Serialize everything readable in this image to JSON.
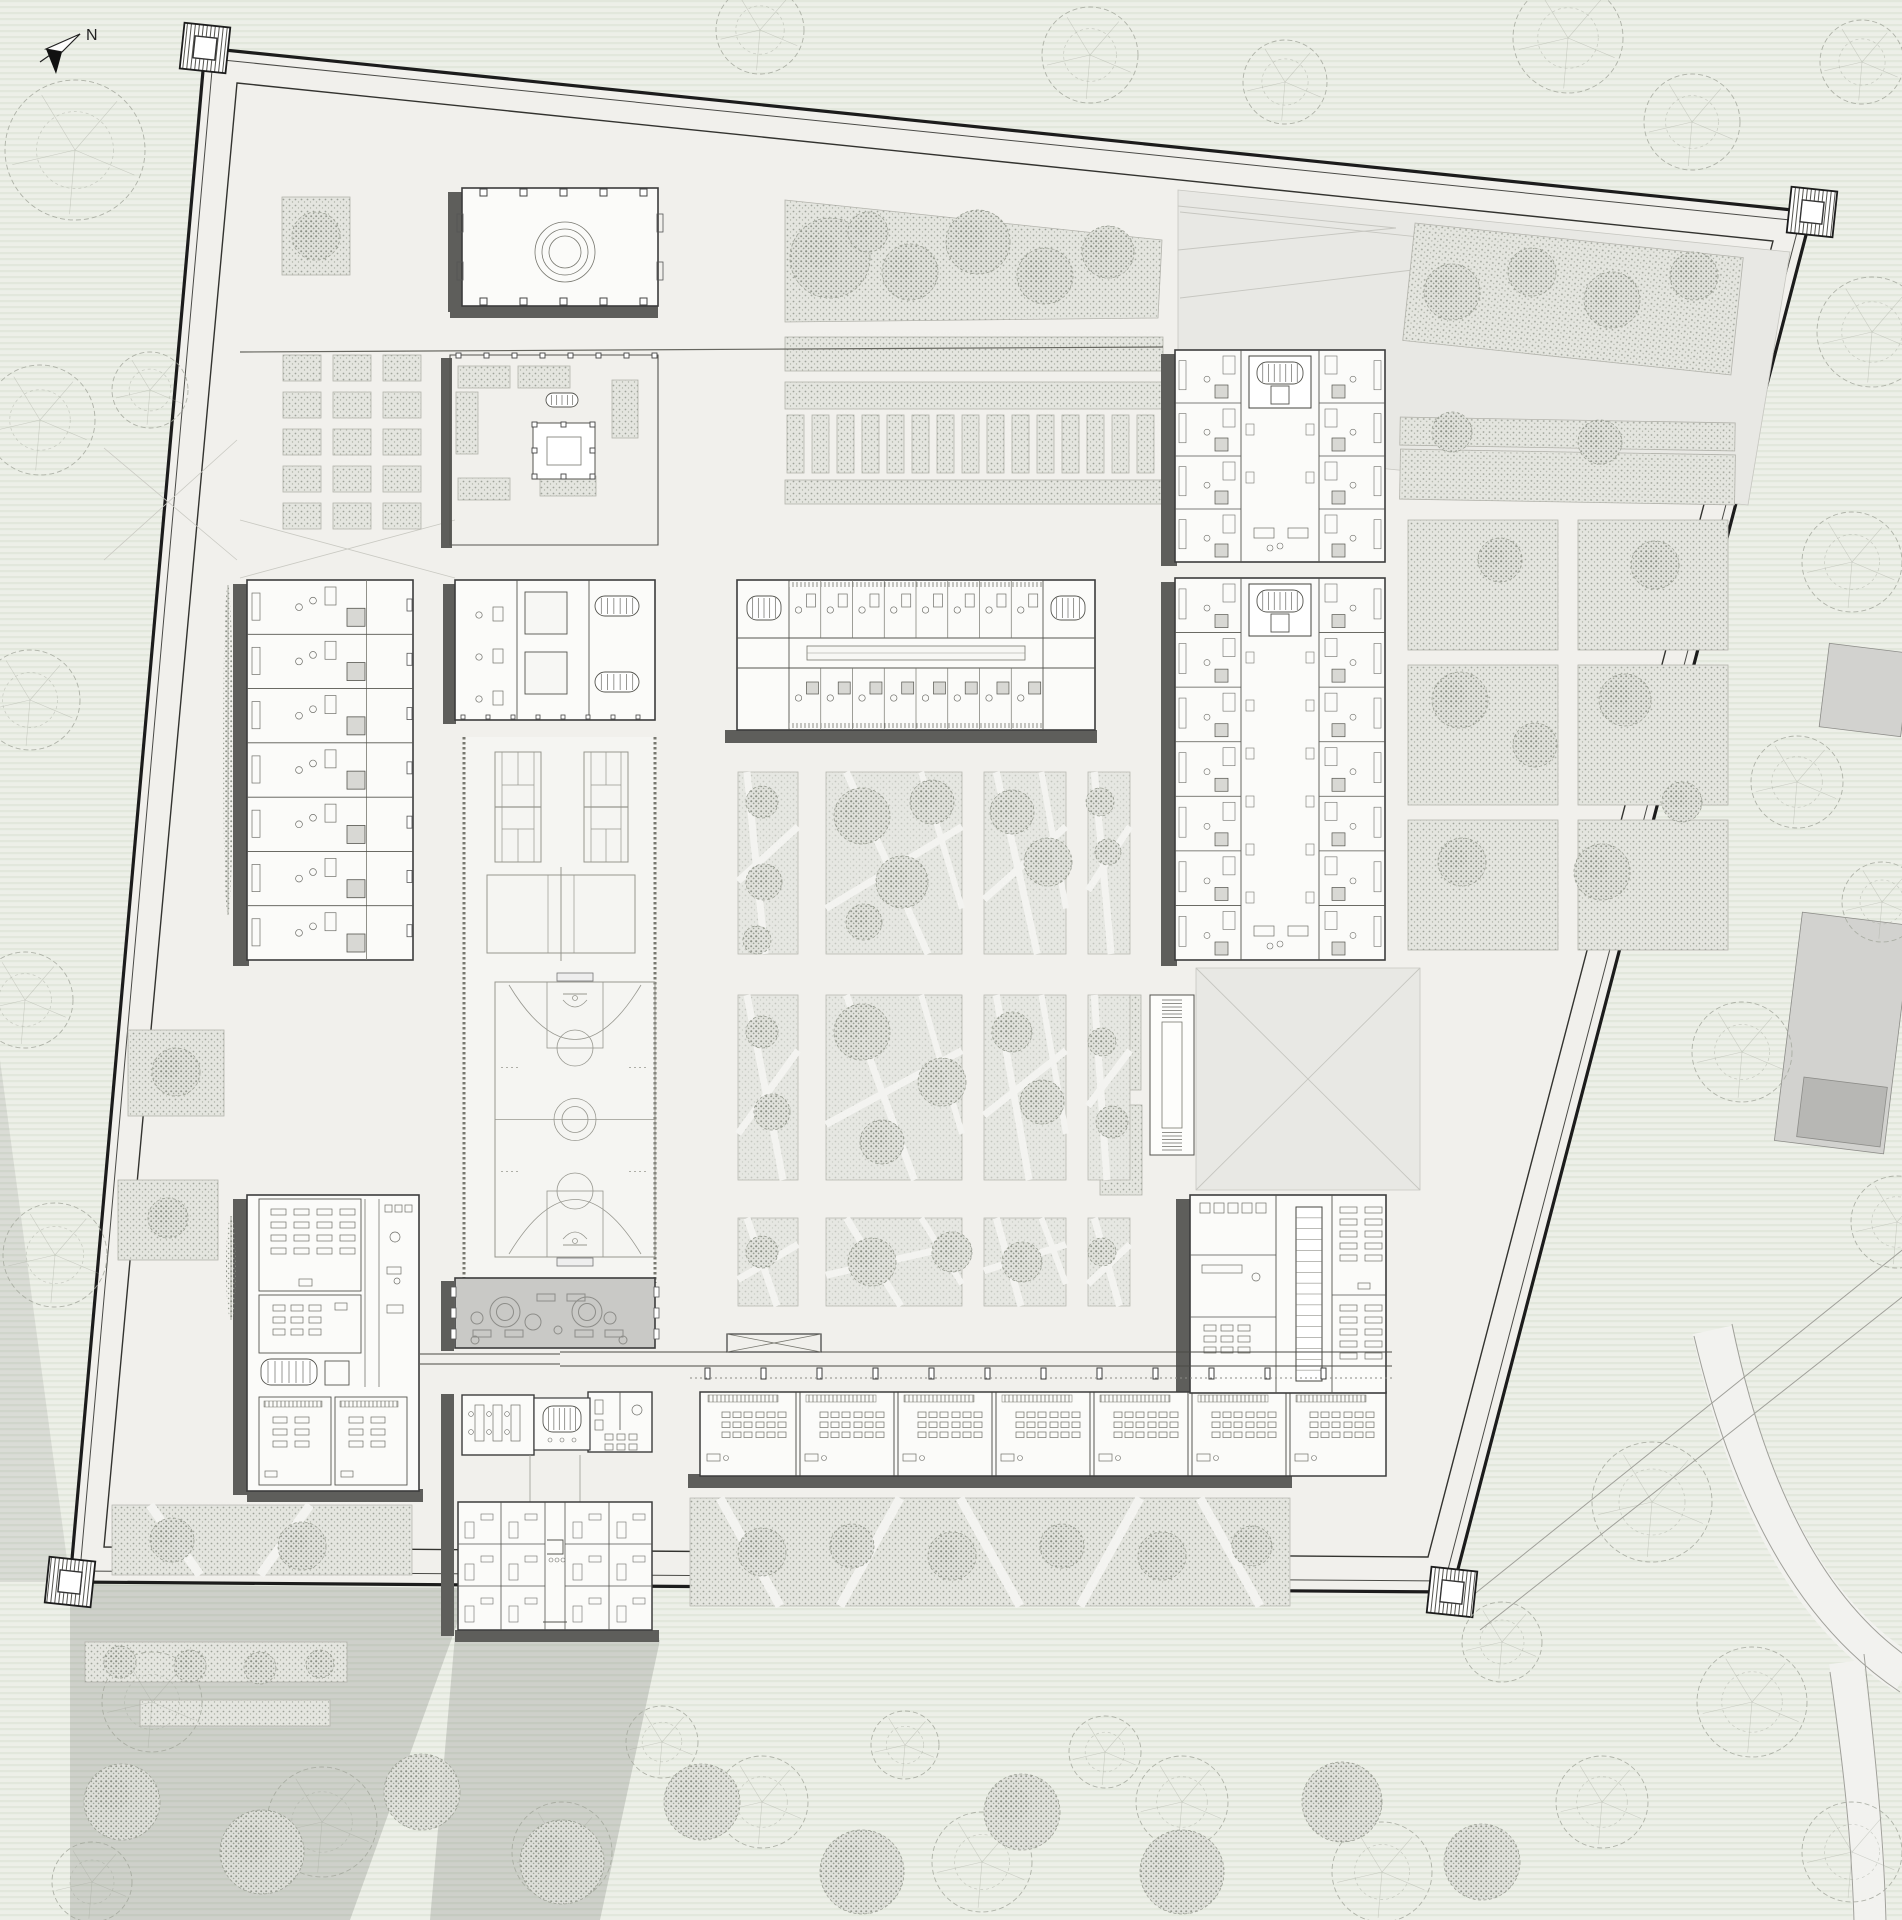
{
  "meta": {
    "title": "walled-campus-site-plan",
    "north_label": "N"
  },
  "canvas": {
    "width": 1902,
    "height": 1920
  },
  "colors": {
    "paper": "#eef0ea",
    "stripe": "#dfe4d8",
    "ground": "#f1f0ec",
    "wall": "#1c1c1c",
    "line": "#3c3c3c",
    "thin": "#8a8a85",
    "shadow": "#5e5e5b",
    "soft_shadow": "rgba(95,100,95,0.22)",
    "stipple_fill": "#e4e5df",
    "stipple_dot": "#a0a49a",
    "tree_line": "#a4a89d",
    "gray_roof": "#c9c9c6",
    "plaza": "#e8e8e4",
    "plaza_line": "#c6c6c0",
    "court_line": "#97978f",
    "court_ground": "#f5f5f2",
    "road_fill": "#f2f2ef",
    "road_line": "#a0a09a",
    "neighbor": "#d2d2cf",
    "neighbor_dark": "#b7b7b4",
    "white": "#fbfbf9"
  },
  "site": {
    "outer": [
      [
        205,
        48
      ],
      [
        1812,
        212
      ],
      [
        1452,
        1592
      ],
      [
        70,
        1582
      ]
    ],
    "inner1": [
      [
        213,
        59
      ],
      [
        1800,
        221
      ],
      [
        1445,
        1581
      ],
      [
        80,
        1571
      ]
    ],
    "inner2": [
      [
        237,
        83
      ],
      [
        1773,
        241
      ],
      [
        1428,
        1557
      ],
      [
        104,
        1547
      ]
    ],
    "towers": [
      [
        205,
        48
      ],
      [
        1812,
        212
      ],
      [
        1452,
        1592
      ],
      [
        70,
        1582
      ]
    ],
    "tower_size": 46,
    "tower_rot": 6
  },
  "shadows": {
    "building": [
      [
        233,
        584,
        16,
        382
      ],
      [
        448,
        192,
        14,
        120
      ],
      [
        450,
        305,
        208,
        13
      ],
      [
        441,
        358,
        11,
        190
      ],
      [
        443,
        584,
        13,
        140
      ],
      [
        725,
        730,
        372,
        13
      ],
      [
        1161,
        354,
        16,
        212
      ],
      [
        1161,
        582,
        16,
        384
      ],
      [
        233,
        1199,
        16,
        296
      ],
      [
        247,
        1489,
        176,
        13
      ],
      [
        441,
        1281,
        13,
        70
      ],
      [
        441,
        1394,
        13,
        242
      ],
      [
        455,
        1630,
        204,
        12
      ],
      [
        1176,
        1199,
        15,
        200
      ],
      [
        688,
        1474,
        604,
        14
      ]
    ],
    "soft": [
      [
        [
          70,
          1584
        ],
        [
          470,
          1588
        ],
        [
          350,
          1920
        ],
        [
          70,
          1920
        ]
      ],
      [
        [
          455,
          1636
        ],
        [
          660,
          1640
        ],
        [
          600,
          1920
        ],
        [
          430,
          1920
        ]
      ],
      [
        [
          0,
          1060
        ],
        [
          70,
          1582
        ],
        [
          0,
          1582
        ]
      ]
    ]
  },
  "plazas": [
    {
      "name": "northeast-plaza",
      "pts": [
        [
          1178,
          190
        ],
        [
          1790,
          252
        ],
        [
          1748,
          505
        ],
        [
          1178,
          448
        ]
      ],
      "lines": [
        [
          1178,
          206,
          1396,
          228
        ],
        [
          1178,
          250,
          1396,
          228
        ],
        [
          1180,
          212,
          1562,
          252
        ],
        [
          1180,
          298,
          1562,
          252
        ]
      ]
    },
    {
      "name": "east-plaza",
      "pts": [
        [
          1196,
          968
        ],
        [
          1420,
          968
        ],
        [
          1420,
          1190
        ],
        [
          1196,
          1190
        ]
      ],
      "lines": [
        [
          1196,
          968,
          1420,
          1190
        ],
        [
          1420,
          968,
          1196,
          1190
        ]
      ]
    }
  ],
  "fold_lines": [
    [
      104,
      448,
      237,
      560
    ],
    [
      237,
      440,
      104,
      560
    ],
    [
      240,
      520,
      455,
      578
    ],
    [
      240,
      578,
      455,
      520
    ]
  ],
  "stipple_polys": [
    [
      [
        785,
        200
      ],
      [
        1162,
        240
      ],
      [
        1158,
        318
      ],
      [
        785,
        322
      ]
    ]
  ],
  "stipple_areas": [
    {
      "x": 282,
      "y": 197,
      "w": 68,
      "h": 78
    },
    {
      "x": 458,
      "y": 366,
      "w": 52,
      "h": 22
    },
    {
      "x": 518,
      "y": 366,
      "w": 52,
      "h": 22
    },
    {
      "x": 612,
      "y": 380,
      "w": 26,
      "h": 58
    },
    {
      "x": 456,
      "y": 392,
      "w": 22,
      "h": 62
    },
    {
      "x": 458,
      "y": 478,
      "w": 52,
      "h": 22
    },
    {
      "x": 540,
      "y": 476,
      "w": 56,
      "h": 20
    },
    {
      "x": 785,
      "y": 337,
      "w": 378,
      "h": 34
    },
    {
      "x": 785,
      "y": 382,
      "w": 378,
      "h": 27
    },
    {
      "x": 785,
      "y": 480,
      "w": 378,
      "h": 24
    },
    {
      "x": 1408,
      "y": 240,
      "w": 330,
      "h": 118,
      "rot": 6
    },
    {
      "x": 1400,
      "y": 420,
      "w": 335,
      "h": 28,
      "rot": 1
    },
    {
      "x": 1400,
      "y": 452,
      "w": 335,
      "h": 50,
      "rot": 1
    },
    {
      "x": 1408,
      "y": 520,
      "w": 150,
      "h": 130
    },
    {
      "x": 1578,
      "y": 520,
      "w": 150,
      "h": 130
    },
    {
      "x": 1408,
      "y": 665,
      "w": 150,
      "h": 140
    },
    {
      "x": 1578,
      "y": 665,
      "w": 150,
      "h": 140
    },
    {
      "x": 1408,
      "y": 820,
      "w": 150,
      "h": 130
    },
    {
      "x": 1578,
      "y": 820,
      "w": 150,
      "h": 130
    },
    {
      "x": 128,
      "y": 1030,
      "w": 96,
      "h": 86
    },
    {
      "x": 118,
      "y": 1180,
      "w": 100,
      "h": 80
    },
    {
      "x": 85,
      "y": 1642,
      "w": 262,
      "h": 40
    },
    {
      "x": 140,
      "y": 1700,
      "w": 190,
      "h": 26
    },
    {
      "x": 1103,
      "y": 995,
      "w": 38,
      "h": 95
    },
    {
      "x": 1100,
      "y": 1105,
      "w": 42,
      "h": 90
    }
  ],
  "bed_grids": [
    {
      "x0": 283,
      "y0": 355,
      "cols": 3,
      "rows": 5,
      "w": 38,
      "h": 26,
      "gx": 12,
      "gy": 11,
      "name": "west-planting-beds"
    },
    {
      "x0": 787,
      "y0": 415,
      "cols": 15,
      "rows": 1,
      "w": 17,
      "h": 58,
      "gx": 8,
      "gy": 0,
      "name": "central-planting-beds"
    }
  ],
  "path_bands": [
    {
      "x": 112,
      "y": 1505,
      "w": 300,
      "h": 70,
      "paths": [
        [
          150,
          1505,
          200,
          1575
        ],
        [
          260,
          1575,
          310,
          1505
        ]
      ]
    },
    {
      "x": 690,
      "y": 1498,
      "w": 600,
      "h": 108,
      "paths": [
        [
          720,
          1498,
          780,
          1606
        ],
        [
          840,
          1606,
          900,
          1498
        ],
        [
          960,
          1498,
          1020,
          1606
        ],
        [
          1080,
          1606,
          1140,
          1498
        ],
        [
          1200,
          1498,
          1260,
          1606
        ]
      ]
    }
  ],
  "garden_grid": {
    "cols": [
      [
        738,
        60
      ],
      [
        826,
        136
      ],
      [
        984,
        82
      ],
      [
        1088,
        42
      ]
    ],
    "rows": [
      [
        772,
        182
      ],
      [
        995,
        185
      ],
      [
        1218,
        88
      ]
    ]
  },
  "courts": {
    "strip": {
      "x1": 463,
      "y1": 737,
      "x2": 656,
      "y2": 1283
    },
    "tennis": [
      {
        "x": 495,
        "y": 752,
        "w": 46,
        "h": 110
      },
      {
        "x": 584,
        "y": 752,
        "w": 44,
        "h": 110
      }
    ],
    "volleyball": {
      "x": 487,
      "y": 875,
      "w": 148,
      "h": 78
    },
    "basketball": {
      "x": 495,
      "y": 982,
      "w": 160,
      "h": 275
    }
  },
  "buildings": [
    {
      "name": "entry-pavilion",
      "kind": "pavilion",
      "x": 462,
      "y": 188,
      "w": 196,
      "h": 118
    },
    {
      "name": "garden-courtyard",
      "kind": "gardenCourt",
      "x": 450,
      "y": 355,
      "w": 208,
      "h": 190
    },
    {
      "name": "west-dormitory",
      "kind": "dormV",
      "x": 247,
      "y": 580,
      "w": 166,
      "h": 380,
      "units": 7
    },
    {
      "name": "west-court-block",
      "kind": "blockCourts",
      "x": 455,
      "y": 580,
      "w": 200,
      "h": 140
    },
    {
      "name": "central-dormitory",
      "kind": "dormH",
      "x": 737,
      "y": 580,
      "w": 358,
      "h": 150
    },
    {
      "name": "east-dormitory-north",
      "kind": "atriumDorm",
      "x": 1175,
      "y": 350,
      "w": 210,
      "h": 212,
      "units": 4
    },
    {
      "name": "east-dormitory-south",
      "kind": "atriumDorm",
      "x": 1175,
      "y": 578,
      "w": 210,
      "h": 382,
      "units": 7
    },
    {
      "name": "ramp-structure",
      "kind": "ramp",
      "x": 1150,
      "y": 995,
      "w": 44,
      "h": 160
    },
    {
      "name": "southwest-classroom-building",
      "kind": "classBlockL",
      "x": 247,
      "y": 1195,
      "w": 172,
      "h": 296
    },
    {
      "name": "multipurpose-hall",
      "kind": "grayHall",
      "x": 455,
      "y": 1278,
      "w": 200,
      "h": 70
    },
    {
      "name": "south-pavilion-building",
      "kind": "pavilionPair",
      "x": 455,
      "y": 1390,
      "w": 200,
      "h": 242
    },
    {
      "name": "south-classroom-wing",
      "kind": "classWing",
      "x": 700,
      "y": 1392,
      "w": 686,
      "h": 84,
      "rooms": 7
    },
    {
      "name": "southeast-classroom-building",
      "kind": "labBlock",
      "x": 1190,
      "y": 1195,
      "w": 196,
      "h": 198
    }
  ],
  "walkways": {
    "covered": [
      [
        560,
        1352,
        1392,
        1352
      ],
      [
        560,
        1366,
        1392,
        1366
      ],
      [
        420,
        1354,
        560,
        1354
      ],
      [
        420,
        1364,
        560,
        1364
      ]
    ],
    "posts": {
      "x0": 705,
      "y": 1368,
      "count": 12,
      "gap": 56,
      "w": 5,
      "h": 11
    },
    "dashed": [
      [
        690,
        1378,
        1392,
        1378
      ]
    ],
    "xband": {
      "x": 727,
      "y": 1334,
      "w": 94,
      "h": 18
    },
    "longline": [
      [
        240,
        352,
        1163,
        347
      ]
    ]
  },
  "roads": {
    "bands": [
      {
        "d": "M1712,1330 C1754,1522 1824,1624 1906,1674",
        "w": 40
      },
      {
        "d": "M1846,1662 C1860,1764 1868,1844 1870,1922",
        "w": 34
      }
    ],
    "edges": [
      "M1694,1336 C1738,1524 1810,1632 1900,1692",
      "M1732,1324 C1772,1518 1842,1610 1906,1656",
      "M1830,1672 C1844,1770 1852,1846 1854,1922",
      "M1864,1654 C1876,1760 1884,1842 1886,1922"
    ],
    "lines": [
      [
        1462,
        1604,
        1906,
        1247
      ],
      [
        1480,
        1630,
        1906,
        1294
      ]
    ]
  },
  "neighbors": [
    {
      "x": 1824,
      "y": 648,
      "w": 82,
      "h": 84,
      "rot": 7
    },
    {
      "x": 1788,
      "y": 918,
      "w": 110,
      "h": 230,
      "rot": 7
    },
    {
      "x": 1800,
      "y": 1082,
      "w": 84,
      "h": 60,
      "rot": 7,
      "dark": true
    }
  ],
  "trees": {
    "outline": [
      [
        75,
        150,
        70
      ],
      [
        40,
        420,
        55
      ],
      [
        30,
        700,
        50
      ],
      [
        25,
        1000,
        48
      ],
      [
        55,
        1255,
        52
      ],
      [
        150,
        390,
        38
      ],
      [
        760,
        30,
        44
      ],
      [
        1090,
        55,
        48
      ],
      [
        1285,
        82,
        42
      ],
      [
        1568,
        38,
        55
      ],
      [
        1692,
        122,
        48
      ],
      [
        1862,
        62,
        42
      ],
      [
        1872,
        332,
        55
      ],
      [
        1852,
        562,
        50
      ],
      [
        1797,
        782,
        46
      ],
      [
        1882,
        902,
        40
      ],
      [
        1742,
        1052,
        50
      ],
      [
        1897,
        1222,
        46
      ],
      [
        1652,
        1502,
        60
      ],
      [
        1752,
        1702,
        55
      ],
      [
        1852,
        1852,
        50
      ],
      [
        1602,
        1802,
        46
      ],
      [
        1502,
        1642,
        40
      ],
      [
        152,
        1702,
        50
      ],
      [
        322,
        1822,
        55
      ],
      [
        562,
        1852,
        50
      ],
      [
        762,
        1802,
        46
      ],
      [
        982,
        1862,
        50
      ],
      [
        1182,
        1802,
        46
      ],
      [
        1382,
        1872,
        50
      ],
      [
        92,
        1882,
        40
      ],
      [
        662,
        1742,
        36
      ],
      [
        905,
        1745,
        34
      ],
      [
        1105,
        1752,
        36
      ]
    ],
    "stipple": [
      [
        830,
        258,
        40
      ],
      [
        910,
        272,
        28
      ],
      [
        978,
        242,
        32
      ],
      [
        1045,
        276,
        28
      ],
      [
        1108,
        252,
        26
      ],
      [
        868,
        232,
        20
      ],
      [
        1452,
        292,
        28
      ],
      [
        1532,
        272,
        24
      ],
      [
        1612,
        300,
        28
      ],
      [
        1694,
        276,
        24
      ],
      [
        1452,
        432,
        20
      ],
      [
        1600,
        442,
        22
      ],
      [
        1500,
        560,
        22
      ],
      [
        1655,
        565,
        24
      ],
      [
        1460,
        700,
        28
      ],
      [
        1535,
        745,
        22
      ],
      [
        1625,
        700,
        26
      ],
      [
        1462,
        862,
        24
      ],
      [
        1602,
        872,
        28
      ],
      [
        1682,
        802,
        20
      ],
      [
        762,
        802,
        16
      ],
      [
        764,
        882,
        18
      ],
      [
        757,
        940,
        14
      ],
      [
        862,
        816,
        28
      ],
      [
        932,
        802,
        22
      ],
      [
        902,
        882,
        26
      ],
      [
        864,
        922,
        18
      ],
      [
        1012,
        812,
        22
      ],
      [
        1048,
        862,
        24
      ],
      [
        1100,
        802,
        14
      ],
      [
        1108,
        852,
        13
      ],
      [
        762,
        1032,
        16
      ],
      [
        772,
        1112,
        18
      ],
      [
        862,
        1032,
        28
      ],
      [
        942,
        1082,
        24
      ],
      [
        882,
        1142,
        22
      ],
      [
        1012,
        1032,
        20
      ],
      [
        1042,
        1102,
        22
      ],
      [
        1102,
        1042,
        14
      ],
      [
        1112,
        1122,
        16
      ],
      [
        762,
        1252,
        16
      ],
      [
        872,
        1262,
        24
      ],
      [
        952,
        1252,
        20
      ],
      [
        1022,
        1262,
        20
      ],
      [
        1102,
        1252,
        14
      ],
      [
        762,
        1552,
        24
      ],
      [
        852,
        1546,
        22
      ],
      [
        952,
        1556,
        24
      ],
      [
        1062,
        1546,
        22
      ],
      [
        1162,
        1556,
        24
      ],
      [
        1252,
        1546,
        20
      ],
      [
        172,
        1540,
        22
      ],
      [
        302,
        1546,
        24
      ],
      [
        176,
        1072,
        24
      ],
      [
        168,
        1218,
        20
      ],
      [
        316,
        236,
        24
      ],
      [
        122,
        1802,
        38
      ],
      [
        262,
        1852,
        42
      ],
      [
        422,
        1792,
        38
      ],
      [
        562,
        1862,
        42
      ],
      [
        702,
        1802,
        38
      ],
      [
        862,
        1872,
        42
      ],
      [
        1022,
        1812,
        38
      ],
      [
        1182,
        1872,
        42
      ],
      [
        1342,
        1802,
        40
      ],
      [
        1482,
        1862,
        38
      ],
      [
        120,
        1662,
        16
      ],
      [
        190,
        1666,
        16
      ],
      [
        260,
        1668,
        16
      ],
      [
        320,
        1664,
        14
      ]
    ],
    "cypress": [
      {
        "x": 228,
        "y": 585,
        "h": 330
      },
      {
        "x": 231,
        "y": 1216,
        "h": 104
      }
    ]
  },
  "north": {
    "label_x": 86,
    "label_y": 40
  }
}
